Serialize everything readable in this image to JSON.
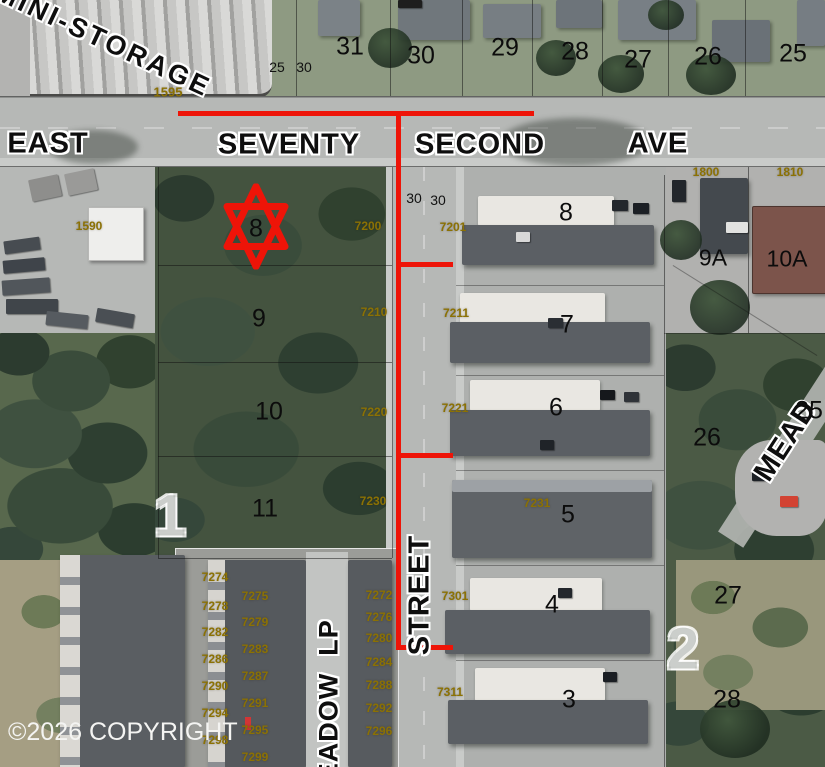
{
  "map": {
    "copyright": "©2026 COPYRIGHT",
    "colors": {
      "annotation_red": "#ee1408",
      "parcel_number_olive": "#8b7104"
    },
    "road_labels": {
      "east": "EAST",
      "seventy": "SEVENTY",
      "second": "SECOND",
      "ave": "AVE",
      "street": "STREET",
      "meadow_lp": "MEADOW  LP",
      "mead_partial": "MEAD",
      "mini_storage": "MINI-STORAGE"
    },
    "marker_lot": "8",
    "blocks": [
      "1",
      "2"
    ],
    "lot_numbers_top": [
      "31",
      "30",
      "29",
      "28",
      "27",
      "26",
      "25"
    ],
    "width_labels": [
      "25",
      "30",
      "30",
      "30"
    ],
    "woods_lots": [
      "9",
      "10",
      "11"
    ],
    "building_numbers": [
      "8",
      "7",
      "6",
      "5",
      "4",
      "3"
    ],
    "unit_labels": [
      "9A",
      "10A"
    ],
    "side_lots": [
      "26",
      "25",
      "27",
      "28"
    ],
    "addresses": {
      "misc": [
        "1595",
        "1590",
        "1800",
        "1810"
      ],
      "west_street": [
        "7200",
        "7210",
        "7220",
        "7230"
      ],
      "east_street": [
        "7201",
        "7211",
        "7221",
        "7231",
        "7301",
        "7311"
      ],
      "col_a": [
        "7274",
        "7278",
        "7282",
        "7286",
        "7290",
        "7294",
        "7298"
      ],
      "col_b": [
        "7275",
        "7279",
        "7283",
        "7287",
        "7291",
        "7295",
        "7299"
      ],
      "col_c": [
        "7272",
        "7276",
        "7280",
        "7284",
        "7288",
        "7292",
        "7296"
      ]
    }
  }
}
